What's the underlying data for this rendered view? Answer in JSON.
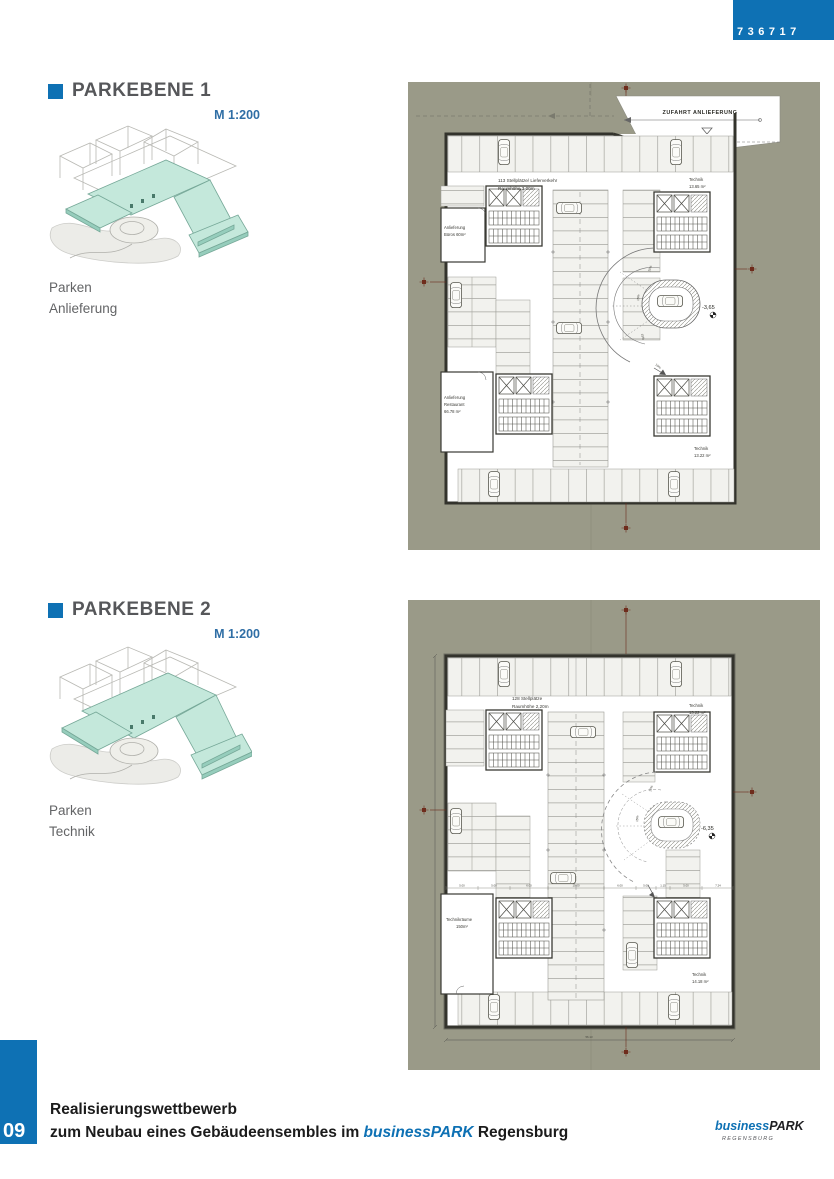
{
  "page": {
    "competition_number": "736717",
    "page_number": "09"
  },
  "colors": {
    "accent_blue": "#0E71B4",
    "scale_blue": "#2F6EA5",
    "heading_gray": "#56575A",
    "caption_gray": "#636466",
    "panel_olive": "#9A9A88",
    "plan_border": "#33332C",
    "survey_marker_red": "#6E2C1C",
    "sketch_teal": "#C4E8DB"
  },
  "sections": [
    {
      "title": "PARKEBENE 1",
      "scale": "M 1:200",
      "caption": [
        "Parken",
        "Anlieferung"
      ],
      "plan": {
        "labels": {
          "entry": "ZUFAHRT ANLIEFERUNG",
          "stats": [
            "113 Stellplätze/ Lieferverkehr",
            "Raumhöhe 3,00m"
          ],
          "technik_top": [
            "Technik",
            "13.65 m²"
          ],
          "anlieferung_bueros": [
            "Anlieferung",
            "Büros 60m²"
          ],
          "anlieferung_restaurant": [
            "Anlieferung",
            "Restaurant",
            "66.78 m²"
          ],
          "technik_bottom": [
            "Technik",
            "13.22 m²"
          ],
          "level": "-3,65",
          "slopes": [
            "10%",
            "15%",
            "15%",
            "10%"
          ]
        }
      }
    },
    {
      "title": "PARKEBENE 2",
      "scale": "M 1:200",
      "caption": [
        "Parken",
        "Technik"
      ],
      "plan": {
        "labels": {
          "stats": [
            "128 Stellplätze",
            "Raumhöhe 2,20m"
          ],
          "technik_top": [
            "Technik",
            "13.22 m²"
          ],
          "technikraeume": [
            "Technikräume",
            "150m²"
          ],
          "technik_bottom": [
            "Technik",
            "14.18 m²"
          ],
          "level": "-6,35",
          "slopes": [
            "10%",
            "15%"
          ],
          "dims_mid": [
            "5.00",
            "5.00",
            "6.00",
            "10.00",
            "6.00",
            "5.00",
            "1.15",
            "5.00",
            "7.24"
          ],
          "dim_bottom": "56.13"
        }
      }
    }
  ],
  "footer": {
    "line1": "Realisierungswettbewerb",
    "line2_prefix": "zum Neubau eines Gebäudeensembles im ",
    "line2_brand": "businessPARK",
    "line2_suffix": " Regensburg",
    "logo": {
      "brand_italic": "business",
      "brand_bold": "PARK",
      "sub": "REGENSBURG"
    }
  }
}
